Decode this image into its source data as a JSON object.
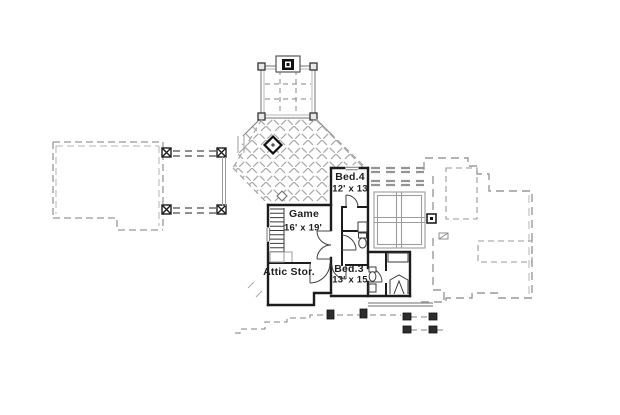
{
  "rooms": {
    "bed4": {
      "name": "Bed.4",
      "dims": "12' x 13"
    },
    "game": {
      "name": "Game",
      "dims": "16' x 19'"
    },
    "attic": {
      "name": "Attic Stor."
    },
    "bed3": {
      "name": "Bed.3",
      "dims": "13' x 15"
    }
  },
  "colors": {
    "wall": "#1c1c1c",
    "roof_dash": "#979797",
    "light_gray": "#aaaaaa",
    "background": "#ffffff"
  }
}
